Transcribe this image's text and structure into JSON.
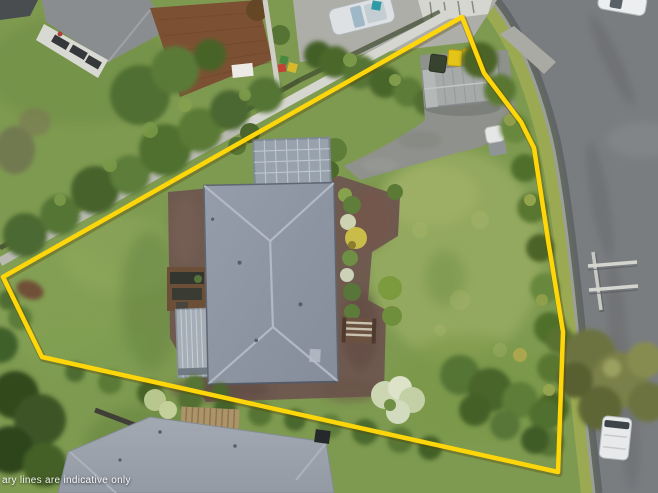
{
  "meta": {
    "kind": "aerial-drone-property-photo",
    "width": 658,
    "height": 493
  },
  "overlay": {
    "disclaimer": "ary lines are indicative only"
  },
  "boundary": {
    "color": "#FFD60A",
    "shadow_color": "rgba(90,70,0,0.35)",
    "points": "462,17 484,73 521,122 534,148 548,240 563,332 558,472 42,357 3,277"
  },
  "scene": {
    "features": [
      "main-house-roof",
      "conservatory-glass-roof",
      "sunroom-glass-roof",
      "rear-deck",
      "brick-paving",
      "garden-beds",
      "lawn",
      "roadside-hedge",
      "road",
      "grass-verge",
      "driveway",
      "garden-shed",
      "wheelie-bins",
      "picnic-table",
      "neighbor-house-top-left",
      "neighbor-deck",
      "retaining-wall",
      "parked-ute",
      "neighbor-house-bottom",
      "flowering-tree",
      "street-tree",
      "utility-pole",
      "parked-van",
      "parked-car"
    ]
  },
  "palette": {
    "grass": "#7E9A50",
    "road": "#7A7D80",
    "main_roof": "#8C94A2",
    "neighbor_roof": "#9AA1AA",
    "paving": "#6F5A50",
    "hedge": "#4C682C",
    "boundary": "#FFD60A"
  }
}
